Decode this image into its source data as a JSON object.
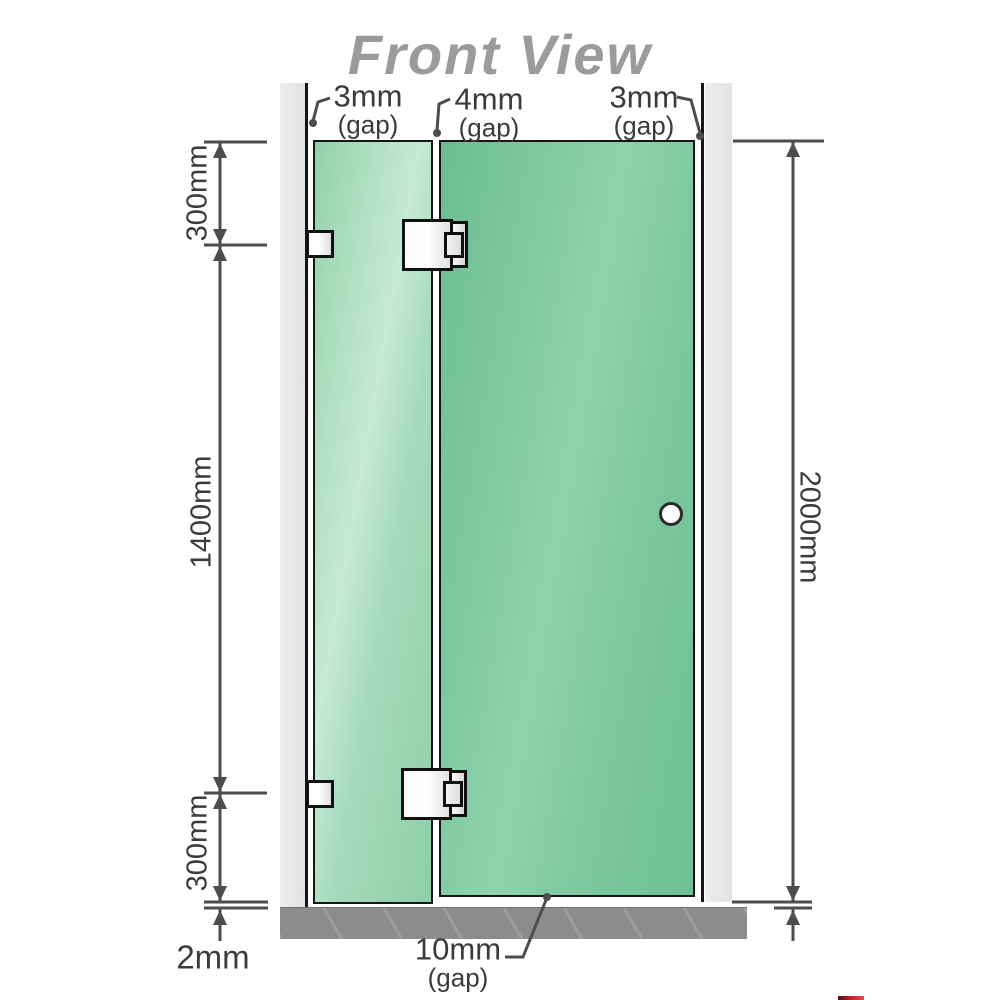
{
  "title": "Front View",
  "gap_labels": {
    "left": {
      "value": "3mm",
      "suffix": "(gap)"
    },
    "middle": {
      "value": "4mm",
      "suffix": "(gap)"
    },
    "right": {
      "value": "3mm",
      "suffix": "(gap)"
    },
    "bottom": {
      "value": "10mm",
      "suffix": "(gap)"
    }
  },
  "dimension_labels": {
    "left_top": "300mm",
    "left_middle": "1400mm",
    "left_bottom": "300mm",
    "floor_gap": "2mm",
    "right_total": "2000mm"
  },
  "colors": {
    "glass_fixed": "#a8dcbd",
    "glass_door": "#7cc9a0",
    "wall_post": "#e9e9e9",
    "floor": "#8c8c8c",
    "outline": "#161616",
    "dimension_line": "#4d4d4d",
    "title_text": "#9b9b9b",
    "label_text": "#3b3b3b",
    "logo_accent": "#d21f2b"
  }
}
